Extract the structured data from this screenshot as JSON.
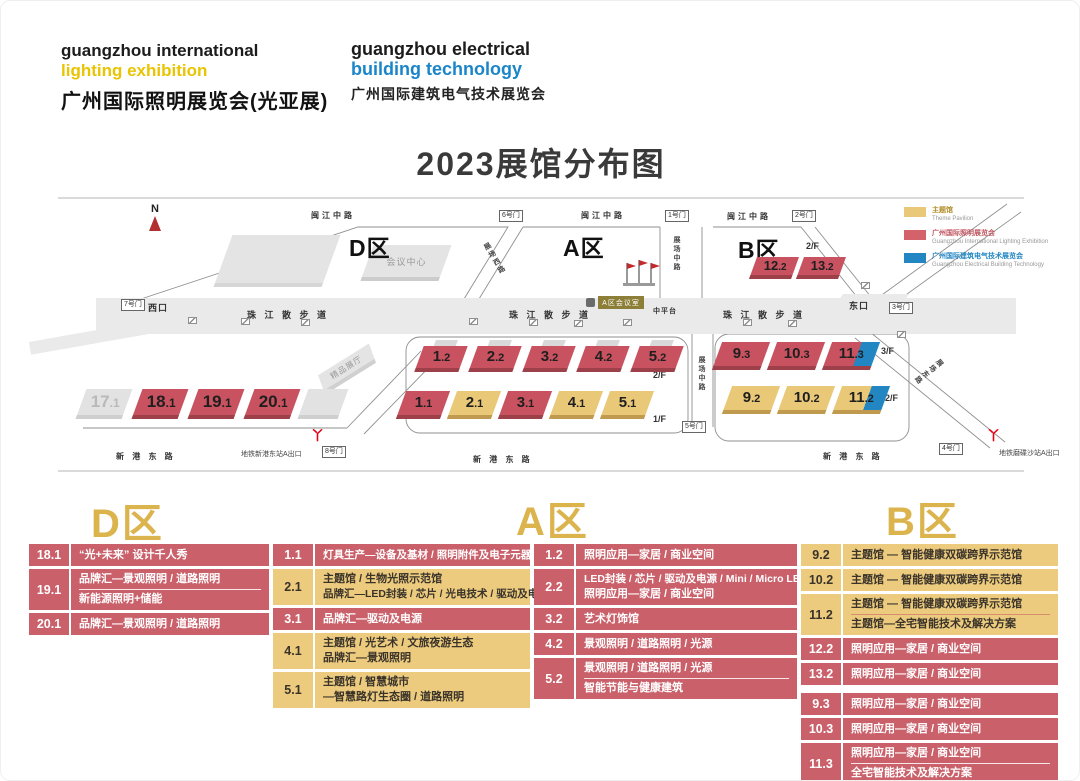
{
  "header": {
    "logo_left": {
      "en1": "guangzhou international",
      "en2": "lighting exhibition",
      "cn": "广州国际照明展览会(光亚展)"
    },
    "logo_right": {
      "en1": "guangzhou electrical",
      "en2": "building technology",
      "cn": "广州国际建筑电气技术展览会"
    },
    "title": "2023展馆分布图"
  },
  "legend": {
    "theme": {
      "cn": "主题馆",
      "en": "Theme Pavilion",
      "color": "#e9c878"
    },
    "lighting": {
      "cn": "广州国际照明展览会",
      "en": "Guangzhou International Lighting Exhibition",
      "color": "#d4626b"
    },
    "electrical": {
      "cn": "广州国际建筑电气技术展览会",
      "en": "Guangzhou Electrical Building Technology",
      "color": "#2286c3"
    }
  },
  "map": {
    "north": "N",
    "zone_labels": {
      "d": "D区",
      "a": "A区",
      "b": "B区"
    },
    "roads": {
      "minjiang": "闽江中路",
      "zhujiang": "珠 江 散 步 道",
      "zhongpingtai": "中平台",
      "zhanchang_zhong": "展场中路",
      "zhanchang_xi": "展场西路",
      "zhanchang_dong": "展场东路",
      "xingang": "新 港 东 路"
    },
    "gates": {
      "g1": "1号门",
      "g2": "2号门",
      "g3": "3号门",
      "g4": "4号门",
      "g5": "5号门",
      "g6": "6号门",
      "g7": "7号门",
      "g8": "8号门",
      "west": "西口",
      "east": "东口"
    },
    "buildings": {
      "conference": "会议中心",
      "boutique": "精品展厅",
      "a_meeting": "A区会议室"
    },
    "metro": {
      "left": "地铁新港东站A出口",
      "right": "地铁磨碟沙站A出口"
    },
    "floors": {
      "f1": "1/F",
      "f2": "2/F",
      "f3": "3/F"
    },
    "halls": {
      "h17_1": {
        "n": "17",
        "d": ".1"
      },
      "h18_1": {
        "n": "18",
        "d": ".1"
      },
      "h19_1": {
        "n": "19",
        "d": ".1"
      },
      "h20_1": {
        "n": "20",
        "d": ".1"
      },
      "h1_2": {
        "n": "1",
        "d": ".2"
      },
      "h2_2": {
        "n": "2",
        "d": ".2"
      },
      "h3_2": {
        "n": "3",
        "d": ".2"
      },
      "h4_2": {
        "n": "4",
        "d": ".2"
      },
      "h5_2": {
        "n": "5",
        "d": ".2"
      },
      "h1_1": {
        "n": "1",
        "d": ".1"
      },
      "h2_1": {
        "n": "2",
        "d": ".1"
      },
      "h3_1": {
        "n": "3",
        "d": ".1"
      },
      "h4_1": {
        "n": "4",
        "d": ".1"
      },
      "h5_1": {
        "n": "5",
        "d": ".1"
      },
      "h9_3": {
        "n": "9",
        "d": ".3"
      },
      "h10_3": {
        "n": "10",
        "d": ".3"
      },
      "h11_3": {
        "n": "11",
        "d": ".3"
      },
      "h9_2": {
        "n": "9",
        "d": ".2"
      },
      "h10_2": {
        "n": "10",
        "d": ".2"
      },
      "h11_2": {
        "n": "11",
        "d": ".2"
      },
      "h12_2": {
        "n": "12",
        "d": ".2"
      },
      "h13_2": {
        "n": "13",
        "d": ".2"
      }
    }
  },
  "tables": {
    "d": {
      "title": "D区",
      "rows": [
        {
          "hall": "18.1",
          "lines": [
            "“光+未来” 设计千人秀"
          ]
        },
        {
          "hall": "19.1",
          "lines": [
            "品牌汇—景观照明 / 道路照明",
            "新能源照明+储能"
          ]
        },
        {
          "hall": "20.1",
          "lines": [
            "品牌汇—景观照明 / 道路照明"
          ]
        }
      ]
    },
    "a": {
      "title": "A区",
      "left": {
        "rows": [
          {
            "hall": "1.1",
            "lines": [
              "灯具生产—设备及基材 / 照明附件及电子元器件"
            ]
          },
          {
            "hall": "2.1",
            "lines": [
              "主题馆 / 生物光照示范馆",
              "品牌汇—LED封装 / 芯片 / 光电技术 / 驱动及电源"
            ]
          },
          {
            "hall": "3.1",
            "lines": [
              "品牌汇—驱动及电源"
            ]
          },
          {
            "hall": "4.1",
            "lines": [
              "主题馆 / 光艺术 / 文旅夜游生态",
              "品牌汇—景观照明"
            ]
          },
          {
            "hall": "5.1",
            "lines": [
              "主题馆 / 智慧城市",
              "—智慧路灯生态圈 / 道路照明"
            ]
          }
        ]
      },
      "right": {
        "rows": [
          {
            "hall": "1.2",
            "lines": [
              "照明应用—家居 / 商业空间"
            ]
          },
          {
            "hall": "2.2",
            "lines": [
              "LED封装 / 芯片 / 驱动及电源 / Mini / Micro LED",
              "照明应用—家居 / 商业空间"
            ]
          },
          {
            "hall": "3.2",
            "lines": [
              "艺术灯饰馆"
            ]
          },
          {
            "hall": "4.2",
            "lines": [
              "景观照明 / 道路照明 / 光源"
            ]
          },
          {
            "hall": "5.2",
            "lines": [
              "景观照明 / 道路照明 / 光源",
              "智能节能与健康建筑"
            ]
          }
        ]
      }
    },
    "b": {
      "title": "B区",
      "rows": [
        {
          "hall": "9.2",
          "lines": [
            "主题馆 — 智能健康双碳跨界示范馆"
          ]
        },
        {
          "hall": "10.2",
          "lines": [
            "主题馆 — 智能健康双碳跨界示范馆"
          ]
        },
        {
          "hall": "11.2",
          "lines": [
            "主题馆 — 智能健康双碳跨界示范馆",
            "主题馆—全宅智能技术及解决方案"
          ]
        },
        {
          "hall": "12.2",
          "lines": [
            "照明应用—家居 / 商业空间"
          ]
        },
        {
          "hall": "13.2",
          "lines": [
            "照明应用—家居 / 商业空间"
          ]
        },
        {
          "hall": "9.3",
          "lines": [
            "照明应用—家居 / 商业空间"
          ]
        },
        {
          "hall": "10.3",
          "lines": [
            "照明应用—家居 / 商业空间"
          ]
        },
        {
          "hall": "11.3",
          "lines": [
            "照明应用—家居 / 商业空间",
            "全宅智能技术及解决方案"
          ]
        }
      ]
    }
  }
}
